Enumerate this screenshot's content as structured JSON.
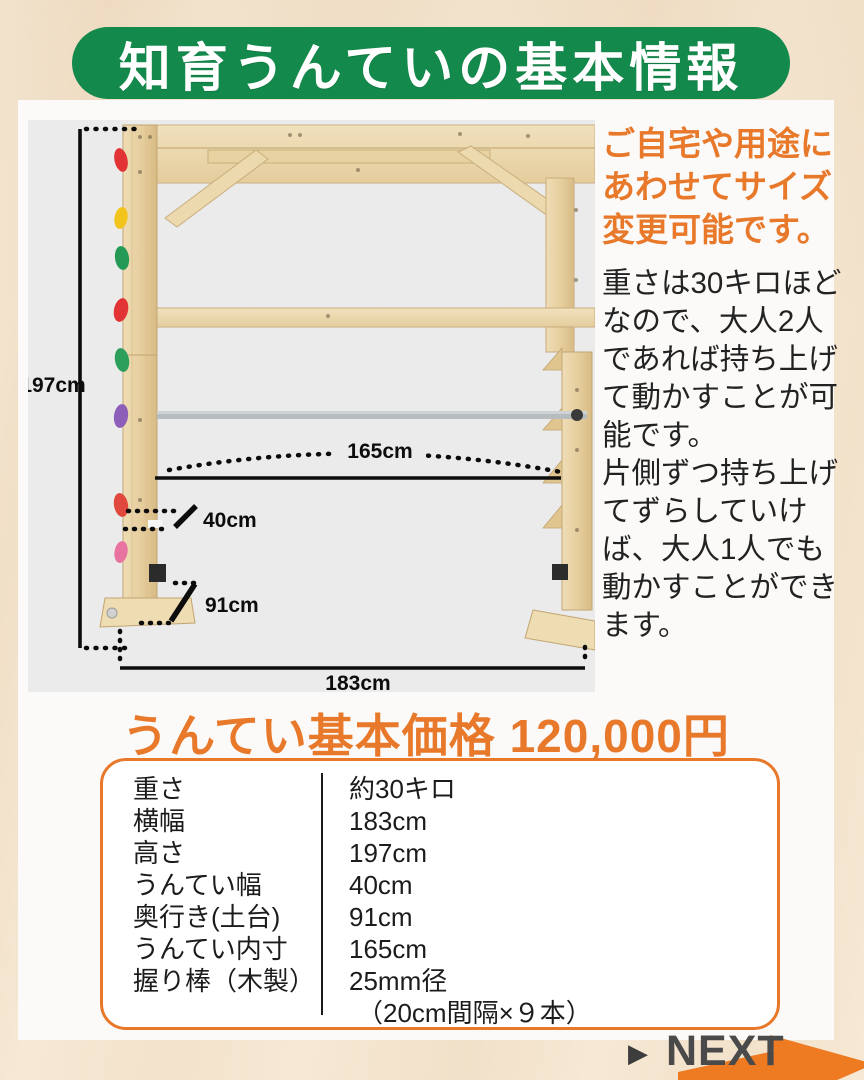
{
  "colors": {
    "banner_green": "#13894b",
    "accent_orange": "#e8782a",
    "photo_background": "#ebebeb",
    "arrow_orange": "#ee7a22",
    "next_text_gray": "#4a4a4a"
  },
  "banner": {
    "title": "知育うんていの基本情報"
  },
  "photo": {
    "labels": {
      "height": "197cm",
      "inner_width": "165cm",
      "untei_width": "40cm",
      "depth": "91cm",
      "total_width": "183cm"
    }
  },
  "info": {
    "highlight": "ご自宅や用途にあわせてサイズ変更可能です。",
    "para1": "重さは30キロほどなので、大人2人であれば持ち上げて動かすことが可能です。",
    "para2": "片側ずつ持ち上げてずらしていけば、大人1人でも動かすことができます。"
  },
  "price": {
    "heading": "うんてい基本価格 120,000円"
  },
  "spec_table": {
    "rows": [
      {
        "label": "重さ",
        "value": "約30キロ"
      },
      {
        "label": "横幅",
        "value": "183cm"
      },
      {
        "label": "高さ",
        "value": "197cm"
      },
      {
        "label": "うんてい幅",
        "value": "40cm"
      },
      {
        "label": "奥行き(土台)",
        "value": "91cm"
      },
      {
        "label": "うんてい内寸",
        "value": "165cm"
      },
      {
        "label": "握り棒（木製）",
        "value": "25mm径",
        "value2": "（20cm間隔×９本）"
      }
    ]
  },
  "next": {
    "triangle": "▶",
    "label": "NEXT"
  }
}
